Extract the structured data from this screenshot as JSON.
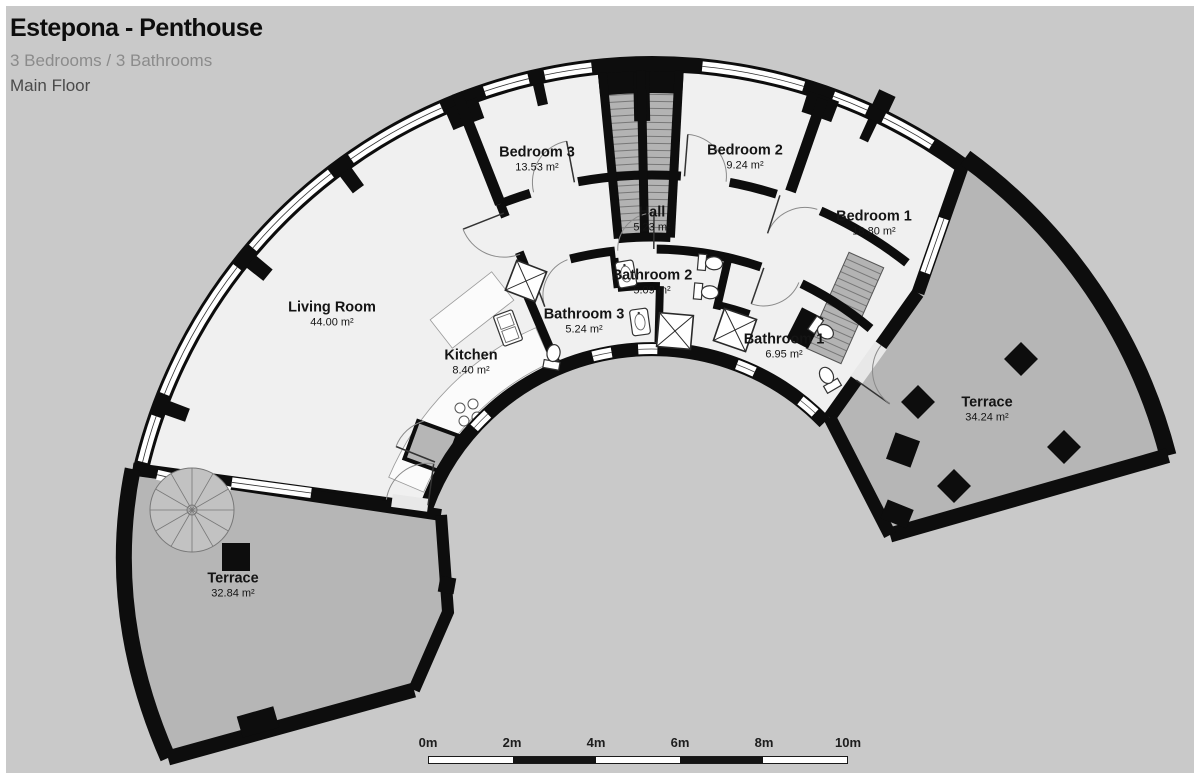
{
  "header": {
    "title": "Estepona - Penthouse",
    "subtitle": "3 Bedrooms / 3 Bathrooms",
    "floor_label": "Main Floor"
  },
  "rooms": [
    {
      "id": "living-room",
      "name": "Living Room",
      "area": "44.00 m²"
    },
    {
      "id": "kitchen",
      "name": "Kitchen",
      "area": "8.40 m²"
    },
    {
      "id": "bedroom-3",
      "name": "Bedroom 3",
      "area": "13.53 m²"
    },
    {
      "id": "hall",
      "name": "Hall",
      "area": "5.23 m²"
    },
    {
      "id": "bedroom-2",
      "name": "Bedroom 2",
      "area": "9.24 m²"
    },
    {
      "id": "bedroom-1",
      "name": "Bedroom 1",
      "area": "18.80 m²"
    },
    {
      "id": "bathroom-3",
      "name": "Bathroom 3",
      "area": "5.24 m²"
    },
    {
      "id": "bathroom-2",
      "name": "Bathroom 2",
      "area": "5.09 m²"
    },
    {
      "id": "bathroom-1",
      "name": "Bathroom 1",
      "area": "6.95 m²"
    },
    {
      "id": "terrace-right",
      "name": "Terrace",
      "area": "34.24 m²"
    },
    {
      "id": "terrace-left",
      "name": "Terrace",
      "area": "32.84 m²"
    }
  ],
  "scale_bar": {
    "ticks": [
      "0m",
      "2m",
      "4m",
      "6m",
      "8m",
      "10m"
    ]
  },
  "colors": {
    "background": "#c9c9c9",
    "frame": "#ffffff",
    "floor": "#f0f0f0",
    "terrace": "#b6b6b6",
    "wall": "#0d0d0d",
    "window": "#ffffff",
    "hatch_fill": "#b3b3b3",
    "hatch_line": "#777777"
  }
}
